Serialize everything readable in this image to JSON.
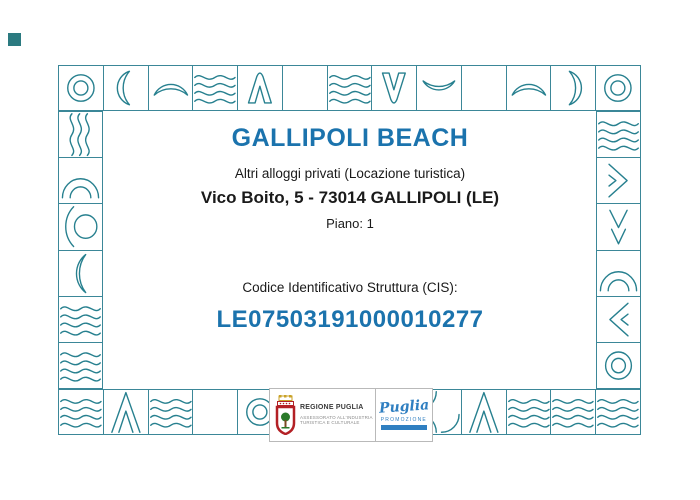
{
  "certificate": {
    "title": "GALLIPOLI BEACH",
    "subtitle": "Altri alloggi privati (Locazione turistica)",
    "address": "Vico Boito, 5 - 73014 GALLIPOLI (LE)",
    "floor": "Piano: 1",
    "cis_label": "Codice Identificativo Struttura (CIS):",
    "cis_code": "LE07503191000010277"
  },
  "footer": {
    "region_name": "REGIONE PUGLIA",
    "region_dept_line1": "ASSESSORATO ALL'INDUSTRIA",
    "region_dept_line2": "TURISTICA E CULTURALE",
    "promo_name": "Puglia",
    "promo_caps": "PROMOZIONE"
  },
  "colors": {
    "accent_blue": "#1b73ad",
    "tile_teal": "#27808f",
    "promo_blue": "#2f7fc1",
    "text": "#1a1a1a"
  },
  "border_tiles": {
    "top": [
      "rings",
      "crescent-left",
      "hump",
      "waves",
      "chevron-up",
      "empty",
      "waves",
      "vee",
      "smile",
      "empty",
      "hump",
      "crescent-right",
      "rings"
    ],
    "left": [
      "vwaves",
      "dome",
      "circle-arc",
      "big-arc",
      "waves",
      "waves"
    ],
    "right": [
      "waves",
      "chevron-right",
      "vee-nested",
      "dome",
      "chevron-left",
      "rings"
    ],
    "bottom": [
      "waves",
      "mountain",
      "waves",
      "empty",
      "rings",
      "empty",
      "empty",
      "empty",
      "corner-arcs",
      "mountain",
      "waves",
      "waves",
      "waves"
    ]
  }
}
